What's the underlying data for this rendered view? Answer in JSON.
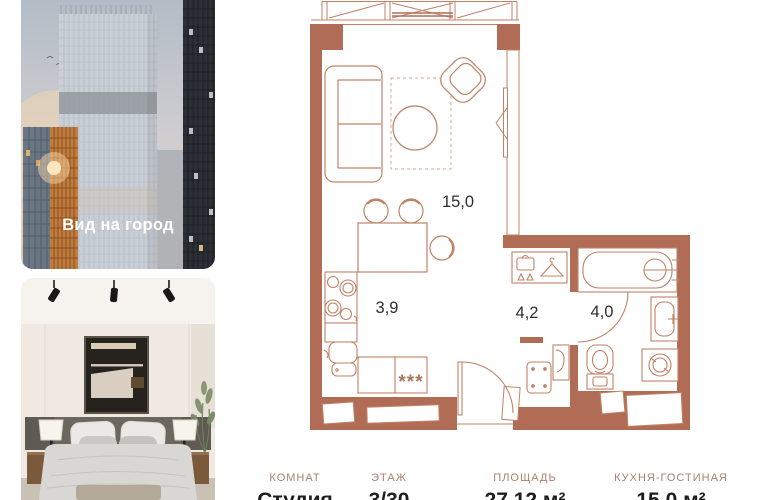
{
  "listing": {
    "photos": {
      "city_view": {
        "caption": "Вид на город"
      },
      "bedroom": {
        "alt": "bedroom interior"
      }
    },
    "floor_plan": {
      "rooms": [
        {
          "name": "living-room",
          "area": "15,0"
        },
        {
          "name": "kitchen",
          "area": "3,9"
        },
        {
          "name": "hallway",
          "area": "4,2"
        },
        {
          "name": "bathroom",
          "area": "4,0"
        }
      ],
      "appliance_marker": "***"
    },
    "info": {
      "columns": [
        {
          "label": "КОМНАТ",
          "value": "Студия"
        },
        {
          "label": "ЭТАЖ",
          "value": "3/30"
        },
        {
          "label": "ПЛОЩАДЬ",
          "value": "27,12 м²"
        },
        {
          "label": "КУХНЯ-ГОСТИНАЯ",
          "value": "15,0 м²"
        }
      ]
    },
    "colors": {
      "wall": "#b16c56",
      "furniture_line": "#c08267",
      "plan_label": "#2e2e2e",
      "label_muted": "#a9826d",
      "value_dark": "#1e1e1e"
    }
  }
}
